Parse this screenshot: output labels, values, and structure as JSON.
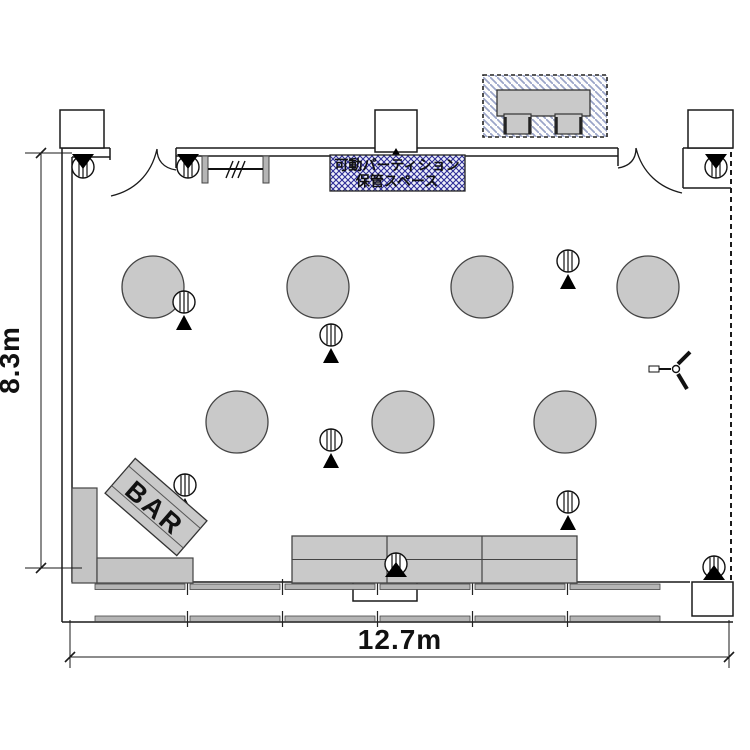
{
  "labels": {
    "bar": "BAR",
    "partition_line1": "可動パーティション",
    "partition_line2": "保管スペース"
  },
  "dimensions": {
    "height": "8.3m",
    "width": "12.7m"
  },
  "colors": {
    "furniture": "#c9c9c9",
    "furniture_outline": "#444444",
    "wall": "#1a1a1a",
    "hatch_line": "#2c2c96",
    "hatch_bg": "#eef0fa",
    "reception_hatch": "#9aa4c8"
  },
  "floorplan": {
    "round_table_radius": 31,
    "round_tables": [
      {
        "x": 153,
        "y": 287
      },
      {
        "x": 318,
        "y": 287
      },
      {
        "x": 482,
        "y": 287
      },
      {
        "x": 648,
        "y": 287
      },
      {
        "x": 237,
        "y": 422
      },
      {
        "x": 403,
        "y": 422
      },
      {
        "x": 565,
        "y": 422
      }
    ],
    "stand_markers": [
      {
        "x": 83,
        "y": 167,
        "variant": "cap-up"
      },
      {
        "x": 188,
        "y": 167,
        "variant": "cap-up"
      },
      {
        "x": 716,
        "y": 167,
        "variant": "cap-up"
      },
      {
        "x": 184,
        "y": 302,
        "variant": "below"
      },
      {
        "x": 331,
        "y": 335,
        "variant": "below"
      },
      {
        "x": 568,
        "y": 261,
        "variant": "below"
      },
      {
        "x": 331,
        "y": 440,
        "variant": "below"
      },
      {
        "x": 185,
        "y": 485,
        "variant": "below"
      },
      {
        "x": 568,
        "y": 502,
        "variant": "below"
      },
      {
        "x": 396,
        "y": 564,
        "variant": "cap-down"
      },
      {
        "x": 714,
        "y": 567,
        "variant": "cap-down"
      }
    ],
    "buffet_table": {
      "x": 292,
      "y": 536,
      "w": 285,
      "h": 47,
      "cols": 3
    },
    "bar_counter_rects": [
      {
        "x": 72,
        "y": 488,
        "w": 25,
        "h": 95
      },
      {
        "x": 97,
        "y": 558,
        "w": 96,
        "h": 25
      }
    ],
    "reception": {
      "box": {
        "x": 483,
        "y": 75,
        "w": 124,
        "h": 62
      },
      "table": {
        "x": 497,
        "y": 90,
        "w": 93,
        "h": 26
      },
      "chairs": [
        {
          "x": 504,
          "y": 114,
          "w": 27,
          "h": 20
        },
        {
          "x": 555,
          "y": 114,
          "w": 27,
          "h": 20
        }
      ]
    },
    "coat_rack": {
      "posts": [
        [
          202,
          156
        ],
        [
          263,
          156
        ]
      ],
      "post_w": 6,
      "post_h": 27,
      "rail_y": 169,
      "hashes_x": 226
    },
    "fan_symbol": {
      "x": 676,
      "y": 369
    }
  }
}
